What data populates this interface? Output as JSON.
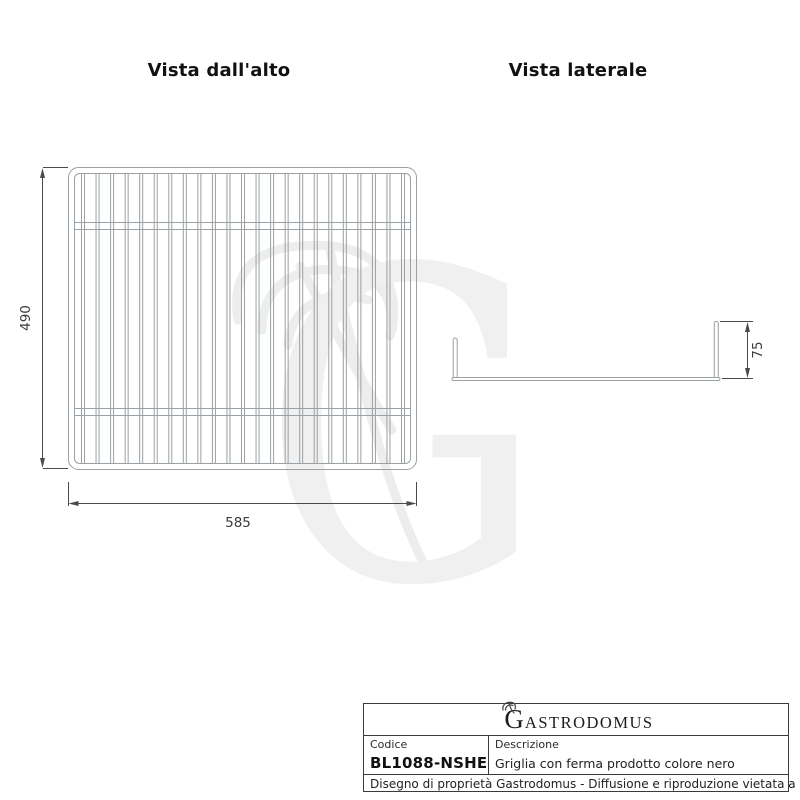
{
  "views": {
    "top": {
      "title": "Vista dall'alto",
      "width_dim": "585",
      "height_dim": "490"
    },
    "side": {
      "title": "Vista laterale",
      "height_dim": "75"
    }
  },
  "title_block": {
    "logo_initial": "G",
    "logo_rest": "ASTRODOMUS",
    "code_label": "Codice",
    "code_value": "BL1088-NSHE",
    "description_label": "Descrizione",
    "description_value": "Griglia con ferma prodotto colore nero",
    "legal": "Disegno di proprietà Gastrodomus - Diffusione e riproduzione vietata a norma di legge."
  },
  "colors": {
    "wire_gray": "#9aa0a3",
    "dimension_gray": "#4a4a4a",
    "text_dark": "#1a1a1a",
    "watermark_gray": "#f0f0f0",
    "table_border": "#3a3a3a"
  },
  "drawing": {
    "wire_count": 23,
    "crossbar_count": 2
  }
}
